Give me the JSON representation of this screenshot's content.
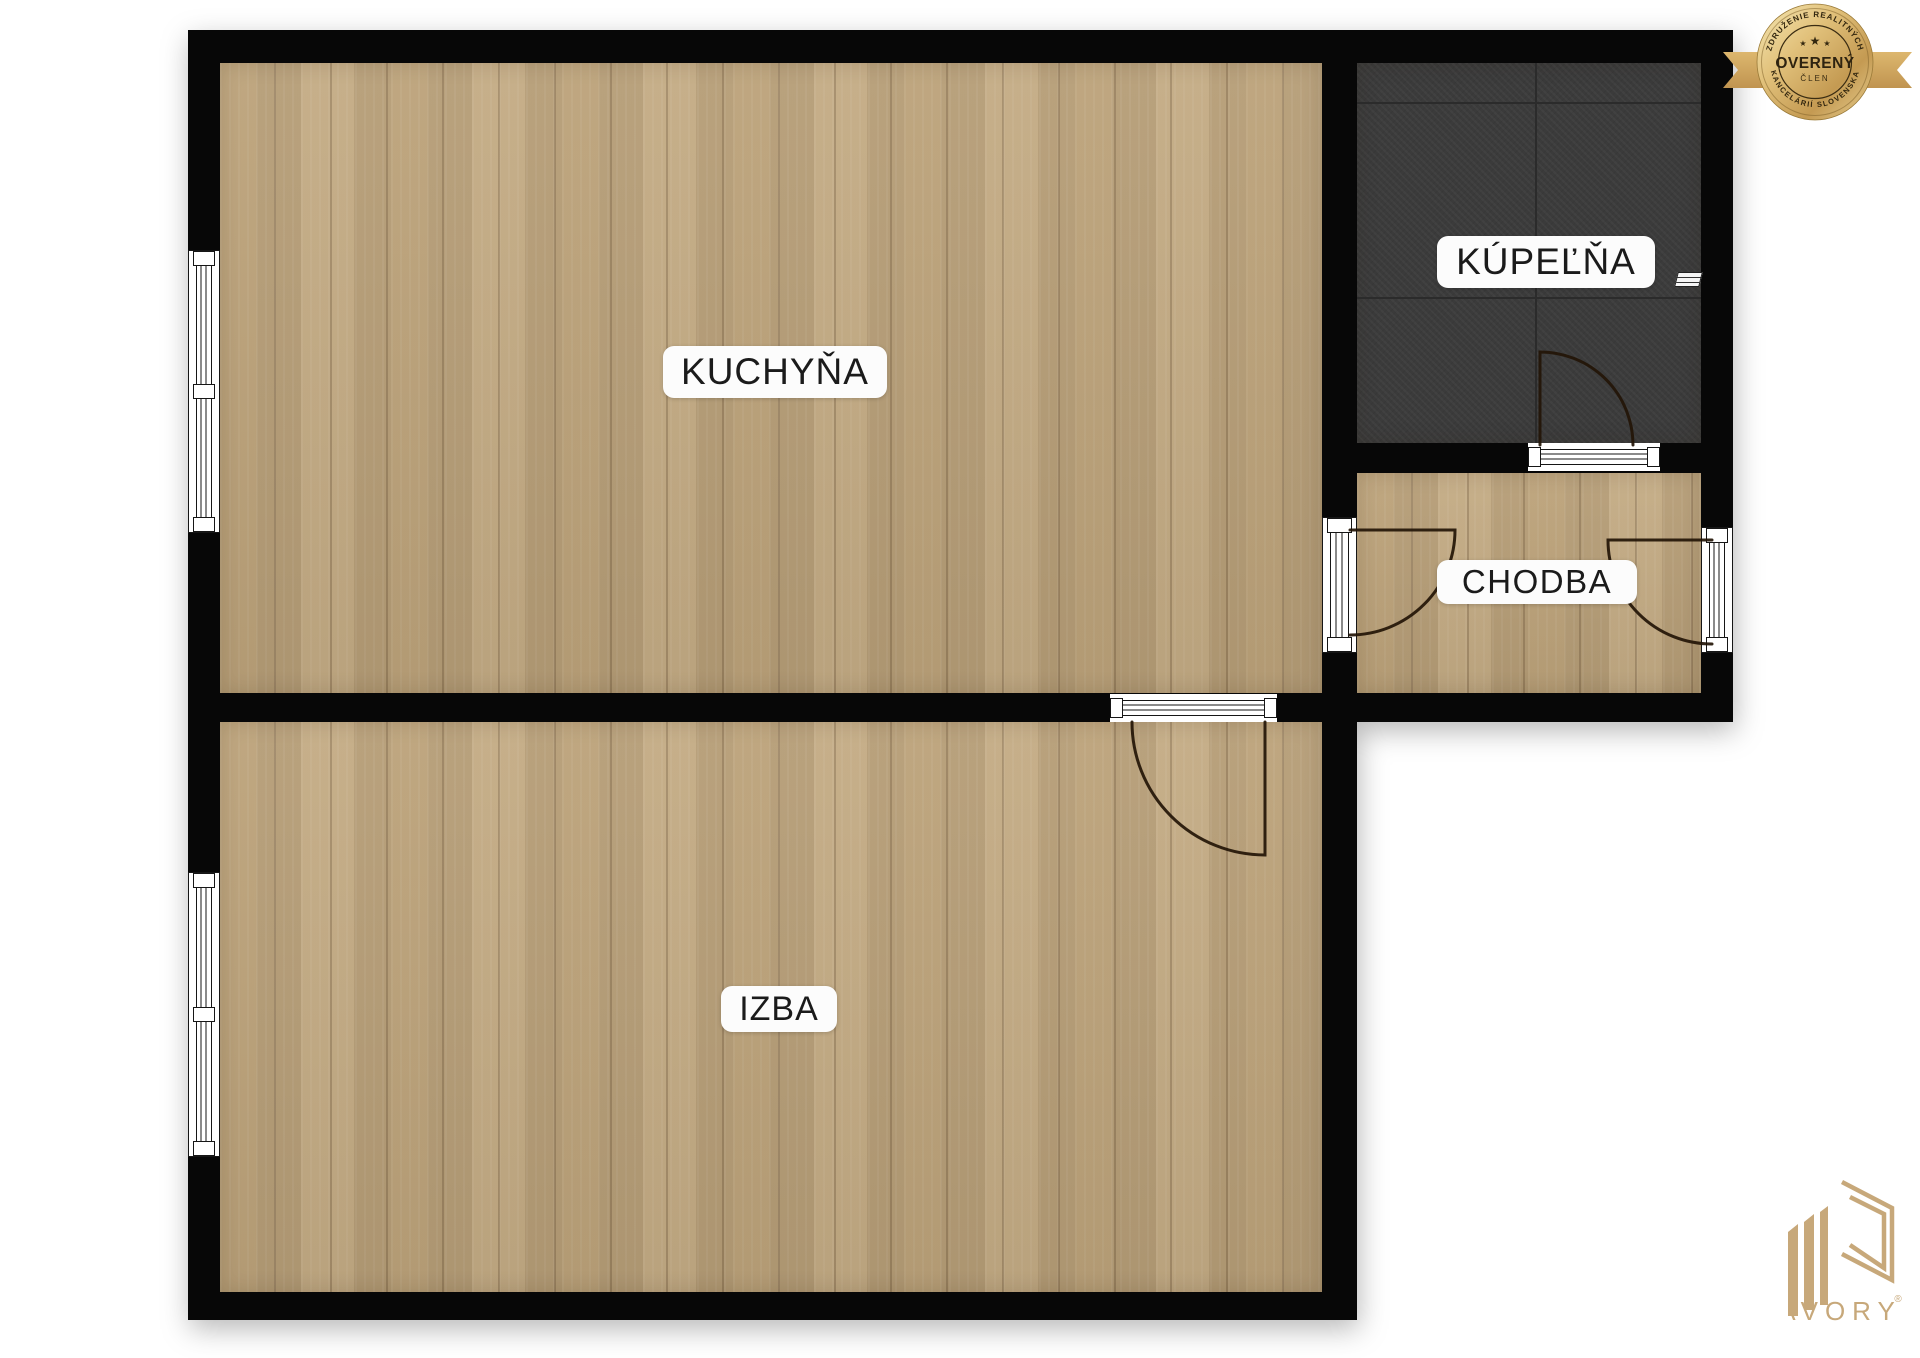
{
  "rooms": {
    "kitchen": {
      "label": "KUCHYŇA"
    },
    "bathroom": {
      "label": "KÚPEĽŇA"
    },
    "hallway": {
      "label": "CHODBA"
    },
    "room": {
      "label": "IZBA"
    }
  },
  "badge": {
    "top_text": "ZDRUŽENIE REALITNÝCH",
    "bottom_text": "KANCELÁRIÍ SLOVENSKA",
    "title": "OVERENÝ",
    "subtitle": "ČLEN",
    "star": "★"
  },
  "logo": {
    "name": "AVORY",
    "registered": "®"
  },
  "colors": {
    "wood": "#bfa67e",
    "tile": "#3b3b3b",
    "grout": "#2b2b2b",
    "wall": "#070707",
    "arc": "#231507",
    "label_bg": "#fcfcfc",
    "label_text": "#1b1b1b",
    "gold": "#c9a25c",
    "gold_light": "#f0dfa8",
    "gold_deep": "#a8803c",
    "logo_gold": "#c7a87a"
  }
}
